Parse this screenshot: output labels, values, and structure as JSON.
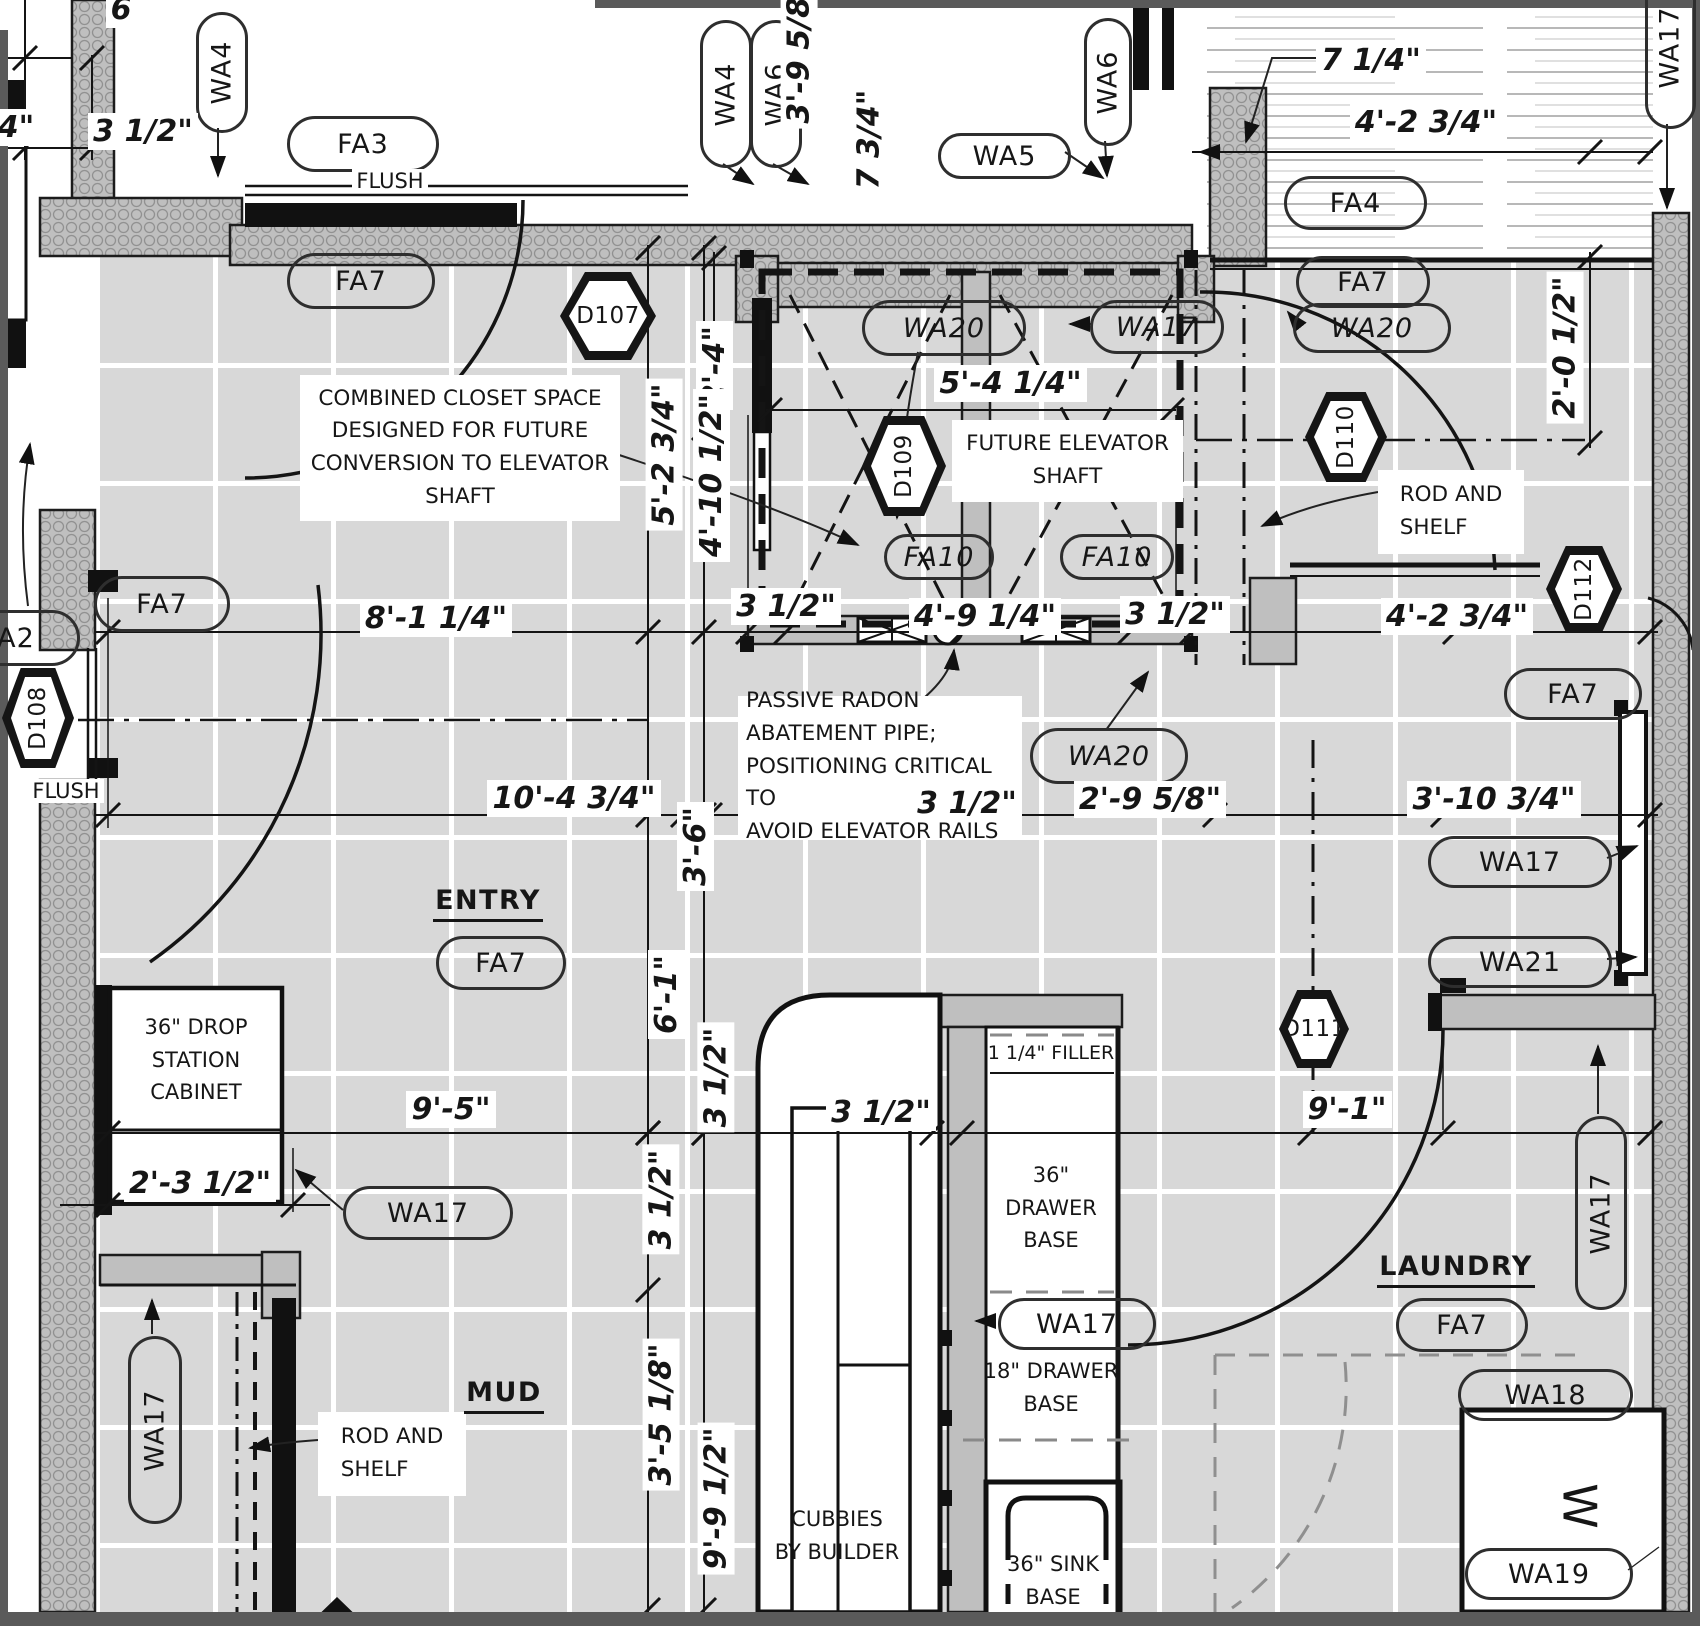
{
  "colors": {
    "ink": "#161616",
    "wall_gray": "#bfbfbf",
    "floor_tile": "#d8d8d8",
    "grout": "#ffffff",
    "frame": "#5a5a5a"
  },
  "annotations": [
    {
      "name": "wall-tag-wa4-left",
      "type": "vpill",
      "x": 196,
      "y": 12,
      "w": 46,
      "h": 115,
      "rot": true,
      "text": "WA4"
    },
    {
      "name": "floor-tag-fa3",
      "type": "pill",
      "x": 287,
      "y": 116,
      "w": 146,
      "h": 50,
      "text": "FA3"
    },
    {
      "name": "flush-note-top",
      "type": "plain",
      "x": 347,
      "y": 168,
      "w": 86,
      "h": 26,
      "text": "FLUSH"
    },
    {
      "name": "wall-tag-wa4-mid",
      "type": "vpill",
      "x": 700,
      "y": 20,
      "w": 46,
      "h": 142,
      "rot": true,
      "text": "WA4"
    },
    {
      "name": "wall-tag-wa6-mid",
      "type": "vpill",
      "x": 750,
      "y": 20,
      "w": 46,
      "h": 142,
      "rot": true,
      "text": "WA6"
    },
    {
      "name": "wall-tag-wa5",
      "type": "pill",
      "x": 938,
      "y": 133,
      "w": 127,
      "h": 40,
      "text": "WA5"
    },
    {
      "name": "wall-tag-wa6-right",
      "type": "vpill",
      "x": 1084,
      "y": 18,
      "w": 42,
      "h": 122,
      "rot": true,
      "text": "WA6"
    },
    {
      "name": "wall-tag-wa17-topright",
      "type": "vpill",
      "x": 1645,
      "y": -35,
      "w": 45,
      "h": 158,
      "rot": true,
      "text": "WA17"
    },
    {
      "name": "floor-tag-fa4",
      "type": "pill",
      "x": 1284,
      "y": 176,
      "w": 137,
      "h": 48,
      "text": "FA4"
    },
    {
      "name": "floor-tag-fa7-closet",
      "type": "pill",
      "x": 287,
      "y": 253,
      "w": 142,
      "h": 50,
      "text": "FA7"
    },
    {
      "name": "door-tag-d107",
      "type": "hex",
      "x": 560,
      "y": 272,
      "w": 96,
      "h": 88,
      "text": "D107"
    },
    {
      "name": "floor-tag-fa7-right",
      "type": "pill",
      "x": 1296,
      "y": 256,
      "w": 128,
      "h": 46,
      "text": "FA7"
    },
    {
      "name": "wall-tag-wa20-right",
      "type": "pill",
      "x": 1293,
      "y": 303,
      "w": 152,
      "h": 44,
      "italic": true,
      "text": "WA20"
    },
    {
      "name": "wall-tag-wa20-shaft",
      "type": "pill",
      "x": 862,
      "y": 300,
      "w": 158,
      "h": 50,
      "italic": true,
      "text": "WA20"
    },
    {
      "name": "wall-tag-wa17-shaft",
      "type": "pill",
      "x": 1090,
      "y": 300,
      "w": 128,
      "h": 48,
      "italic": true,
      "text": "WA17"
    },
    {
      "name": "door-tag-d109",
      "type": "hex",
      "x": 862,
      "y": 416,
      "w": 84,
      "h": 100,
      "rot": true,
      "text": "D109"
    },
    {
      "name": "door-tag-d110",
      "type": "hex",
      "x": 1305,
      "y": 392,
      "w": 82,
      "h": 90,
      "rot": true,
      "text": "D110"
    },
    {
      "name": "future-elevator-note",
      "type": "note",
      "x": 952,
      "y": 420,
      "w": 215,
      "h": 74,
      "text": "FUTURE ELEVATOR\nSHAFT"
    },
    {
      "name": "rod-shelf-note-right",
      "type": "notel",
      "x": 1378,
      "y": 470,
      "w": 130,
      "h": 76,
      "text": "ROD AND\nSHELF"
    },
    {
      "name": "floor-tag-fa10-left",
      "type": "pill",
      "x": 884,
      "y": 534,
      "w": 104,
      "h": 40,
      "italic": true,
      "text": "FA10"
    },
    {
      "name": "floor-tag-fa10-right",
      "type": "pill",
      "x": 1060,
      "y": 534,
      "w": 108,
      "h": 40,
      "italic": true,
      "text": "FA10"
    },
    {
      "name": "door-tag-d112",
      "type": "hex",
      "x": 1546,
      "y": 546,
      "w": 76,
      "h": 86,
      "rot": true,
      "text": "D112"
    },
    {
      "name": "wall-tag-a2",
      "type": "pill",
      "x": -48,
      "y": 610,
      "w": 122,
      "h": 50,
      "text": "A2"
    },
    {
      "name": "floor-tag-fa7-entry-left",
      "type": "pill",
      "x": 94,
      "y": 576,
      "w": 130,
      "h": 50,
      "text": "FA7"
    },
    {
      "name": "door-tag-d108",
      "type": "hex",
      "x": 2,
      "y": 668,
      "w": 72,
      "h": 100,
      "rot": true,
      "text": "D108"
    },
    {
      "name": "flush-note-left",
      "type": "plain",
      "x": 24,
      "y": 778,
      "w": 84,
      "h": 26,
      "text": "FLUSH"
    },
    {
      "name": "radon-note",
      "type": "notel",
      "x": 738,
      "y": 696,
      "w": 268,
      "h": 134,
      "text": "PASSIVE RADON\nABATEMENT PIPE;\nPOSITIONING CRITICAL TO\nAVOID ELEVATOR RAILS"
    },
    {
      "name": "wall-tag-wa20-below",
      "type": "pill",
      "x": 1030,
      "y": 728,
      "w": 152,
      "h": 50,
      "italic": true,
      "text": "WA20"
    },
    {
      "name": "floor-tag-fa7-d112",
      "type": "pill",
      "x": 1504,
      "y": 668,
      "w": 132,
      "h": 46,
      "text": "FA7"
    },
    {
      "name": "room-label-entry",
      "type": "room",
      "x": 438,
      "y": 886,
      "w": 100,
      "h": 34,
      "text": "ENTRY"
    },
    {
      "name": "floor-tag-fa7-entry",
      "type": "pill",
      "x": 436,
      "y": 936,
      "w": 124,
      "h": 48,
      "text": "FA7"
    },
    {
      "name": "wall-tag-wa17-laundrywall",
      "type": "pill",
      "x": 1428,
      "y": 836,
      "w": 178,
      "h": 46,
      "text": "WA17"
    },
    {
      "name": "wall-tag-wa21",
      "type": "pill",
      "x": 1428,
      "y": 936,
      "w": 178,
      "h": 46,
      "text": "WA21"
    },
    {
      "name": "door-tag-d111",
      "type": "hex",
      "x": 1279,
      "y": 990,
      "w": 70,
      "h": 78,
      "text": "D111"
    },
    {
      "name": "drop-station-label",
      "type": "cab",
      "x": 112,
      "y": 1008,
      "w": 168,
      "h": 104,
      "text": "36\" DROP\nSTATION\nCABINET"
    },
    {
      "name": "wall-tag-wa17-dropstation",
      "type": "pill",
      "x": 343,
      "y": 1186,
      "w": 164,
      "h": 48,
      "text": "WA17"
    },
    {
      "name": "wall-tag-wa17-mudcloset",
      "type": "vpill",
      "x": 128,
      "y": 1336,
      "w": 48,
      "h": 182,
      "rot": true,
      "text": "WA17"
    },
    {
      "name": "rod-shelf-note-left",
      "type": "notel",
      "x": 318,
      "y": 1412,
      "w": 132,
      "h": 76,
      "text": "ROD AND\nSHELF"
    },
    {
      "name": "room-label-mud",
      "type": "room",
      "x": 458,
      "y": 1378,
      "w": 92,
      "h": 34,
      "text": "MUD"
    },
    {
      "name": "cubbies-label",
      "type": "cab",
      "x": 772,
      "y": 1502,
      "w": 130,
      "h": 68,
      "text": "CUBBIES\nBY BUILDER"
    },
    {
      "name": "filler-label",
      "type": "cab",
      "x": 984,
      "y": 1040,
      "w": 134,
      "h": 28,
      "fs": 19,
      "text": "1 1/4\" FILLER"
    },
    {
      "name": "drawer-base-36-label",
      "type": "cab",
      "x": 990,
      "y": 1158,
      "w": 122,
      "h": 100,
      "text": "36\"\nDRAWER\nBASE"
    },
    {
      "name": "wall-tag-wa17-cabinet",
      "type": "pill",
      "x": 998,
      "y": 1298,
      "w": 152,
      "h": 46,
      "text": "WA17"
    },
    {
      "name": "drawer-base-18-label",
      "type": "cab",
      "x": 980,
      "y": 1356,
      "w": 142,
      "h": 64,
      "text": "18\" DRAWER\nBASE"
    },
    {
      "name": "sink-base-label",
      "type": "cab",
      "x": 990,
      "y": 1550,
      "w": 126,
      "h": 62,
      "text": "36\" SINK\nBASE"
    },
    {
      "name": "room-label-laundry",
      "type": "room",
      "x": 1396,
      "y": 1252,
      "w": 120,
      "h": 34,
      "text": "LAUNDRY"
    },
    {
      "name": "floor-tag-fa7-laundry",
      "type": "pill",
      "x": 1396,
      "y": 1298,
      "w": 126,
      "h": 48,
      "text": "FA7"
    },
    {
      "name": "wall-tag-wa18",
      "type": "pill",
      "x": 1458,
      "y": 1369,
      "w": 169,
      "h": 46,
      "text": "WA18"
    },
    {
      "name": "washer-letter",
      "type": "wletter",
      "x": 1552,
      "y": 1478,
      "w": 56,
      "h": 56,
      "rot90": true,
      "text": "W"
    },
    {
      "name": "wall-tag-wa19",
      "type": "pill",
      "x": 1465,
      "y": 1548,
      "w": 162,
      "h": 46,
      "text": "WA19"
    },
    {
      "name": "wall-tag-wa17-rightedge",
      "type": "vpill",
      "x": 1575,
      "y": 1116,
      "w": 46,
      "h": 188,
      "rot": true,
      "text": "WA17"
    },
    {
      "name": "combined-closet-note",
      "type": "note",
      "x": 300,
      "y": 375,
      "w": 304,
      "h": 138,
      "text": "COMBINED CLOSET SPACE\nDESIGNED FOR FUTURE\nCONVERSION TO ELEVATOR\nSHAFT"
    },
    {
      "name": "dim-3half-topleft",
      "type": "dim",
      "x": 98,
      "y": 112,
      "w": 90,
      "h": 38,
      "text": "3 1/2\""
    },
    {
      "name": "dim-4in-topleft",
      "type": "dim",
      "x": -6,
      "y": 108,
      "w": 44,
      "h": 38,
      "text": "4\""
    },
    {
      "name": "dim-6-topleft",
      "type": "dim",
      "x": 108,
      "y": -6,
      "w": 26,
      "h": 30,
      "text": "6"
    },
    {
      "name": "dim-3-9-5-8",
      "type": "dimv",
      "x": 780,
      "y": -18,
      "w": 38,
      "h": 140,
      "rot": true,
      "text": "3'-9 5/8\""
    },
    {
      "name": "dim-7-3-4",
      "type": "dimv",
      "x": 850,
      "y": 82,
      "w": 38,
      "h": 115,
      "rot": true,
      "text": "7 3/4\""
    },
    {
      "name": "dim-7-1-4",
      "type": "dim",
      "x": 1320,
      "y": 40,
      "w": 102,
      "h": 40,
      "text": "7 1/4\""
    },
    {
      "name": "dim-4-2-3-4-top",
      "type": "dim",
      "x": 1358,
      "y": 102,
      "w": 136,
      "h": 40,
      "text": "4'-2 3/4\""
    },
    {
      "name": "dim-2-4",
      "type": "dimv",
      "x": 694,
      "y": 315,
      "w": 40,
      "h": 100,
      "rot": true,
      "text": "2'-4\""
    },
    {
      "name": "dim-5-4-1-4",
      "type": "dim",
      "x": 938,
      "y": 362,
      "w": 145,
      "h": 42,
      "text": "5'-4 1/4\""
    },
    {
      "name": "dim-5-2-3-4",
      "type": "dimv",
      "x": 644,
      "y": 372,
      "w": 40,
      "h": 165,
      "rot": true,
      "text": "5'-2 3/4\""
    },
    {
      "name": "dim-4-10-1-2",
      "type": "dimv",
      "x": 692,
      "y": 385,
      "w": 40,
      "h": 180,
      "rot": true,
      "text": "4'-10 1/2\""
    },
    {
      "name": "dim-3half-shaftleft",
      "type": "dim",
      "x": 736,
      "y": 586,
      "w": 100,
      "h": 40,
      "text": "3 1/2\""
    },
    {
      "name": "dim-4-9-1-4",
      "type": "dim",
      "x": 916,
      "y": 596,
      "w": 138,
      "h": 40,
      "text": "4'-9 1/4\""
    },
    {
      "name": "dim-3half-shaftright",
      "type": "dim",
      "x": 1126,
      "y": 594,
      "w": 98,
      "h": 40,
      "text": "3 1/2\""
    },
    {
      "name": "dim-4-2-3-4-right",
      "type": "dim",
      "x": 1386,
      "y": 596,
      "w": 142,
      "h": 40,
      "text": "4'-2 3/4\""
    },
    {
      "name": "dim-8-1-1-4",
      "type": "dim",
      "x": 368,
      "y": 598,
      "w": 136,
      "h": 40,
      "text": "8'-1 1/4\""
    },
    {
      "name": "dim-10-4-3-4",
      "type": "dim",
      "x": 496,
      "y": 778,
      "w": 156,
      "h": 40,
      "text": "10'-4 3/4\""
    },
    {
      "name": "dim-2-9-5-8",
      "type": "dim",
      "x": 1086,
      "y": 780,
      "w": 128,
      "h": 38,
      "text": "2'-9 5/8\""
    },
    {
      "name": "dim-3-10-3-4",
      "type": "dim",
      "x": 1416,
      "y": 780,
      "w": 156,
      "h": 38,
      "text": "3'-10 3/4\""
    },
    {
      "name": "dim-3half-center",
      "type": "dim",
      "x": 918,
      "y": 783,
      "w": 98,
      "h": 40,
      "text": "3 1/2\""
    },
    {
      "name": "dim-3-6",
      "type": "dimv",
      "x": 676,
      "y": 796,
      "w": 38,
      "h": 100,
      "rot": true,
      "text": "3'-6\""
    },
    {
      "name": "dim-6-1",
      "type": "dimv",
      "x": 646,
      "y": 944,
      "w": 40,
      "h": 100,
      "rot": true,
      "text": "6'-1\""
    },
    {
      "name": "dim-3half-v1",
      "type": "dimv",
      "x": 698,
      "y": 1024,
      "w": 36,
      "h": 106,
      "rot": true,
      "text": "3 1/2\""
    },
    {
      "name": "dim-3half-cap",
      "type": "dim",
      "x": 833,
      "y": 1093,
      "w": 96,
      "h": 38,
      "text": "3 1/2\""
    },
    {
      "name": "dim-3half-v2",
      "type": "dimv",
      "x": 643,
      "y": 1143,
      "w": 36,
      "h": 112,
      "rot": true,
      "text": "3 1/2\""
    },
    {
      "name": "dim-9-5",
      "type": "dim",
      "x": 406,
      "y": 1090,
      "w": 90,
      "h": 38,
      "text": "9'-5\""
    },
    {
      "name": "dim-2-3-1-2",
      "type": "dim",
      "x": 130,
      "y": 1163,
      "w": 140,
      "h": 40,
      "text": "2'-3 1/2\""
    },
    {
      "name": "dim-3-5-1-8",
      "type": "dimv",
      "x": 641,
      "y": 1336,
      "w": 40,
      "h": 156,
      "rot": true,
      "text": "3'-5 1/8\""
    },
    {
      "name": "dim-9-9-1-2",
      "type": "dimv",
      "x": 696,
      "y": 1420,
      "w": 40,
      "h": 156,
      "rot": true,
      "text": "9'-9 1/2\""
    },
    {
      "name": "dim-9-1",
      "type": "dim",
      "x": 1303,
      "y": 1090,
      "w": 88,
      "h": 38,
      "text": "9'-1\""
    },
    {
      "name": "dim-2-0-1-2",
      "type": "dimv",
      "x": 1546,
      "y": 282,
      "w": 38,
      "h": 130,
      "rot": true,
      "text": "2'-0 1/2\""
    }
  ]
}
